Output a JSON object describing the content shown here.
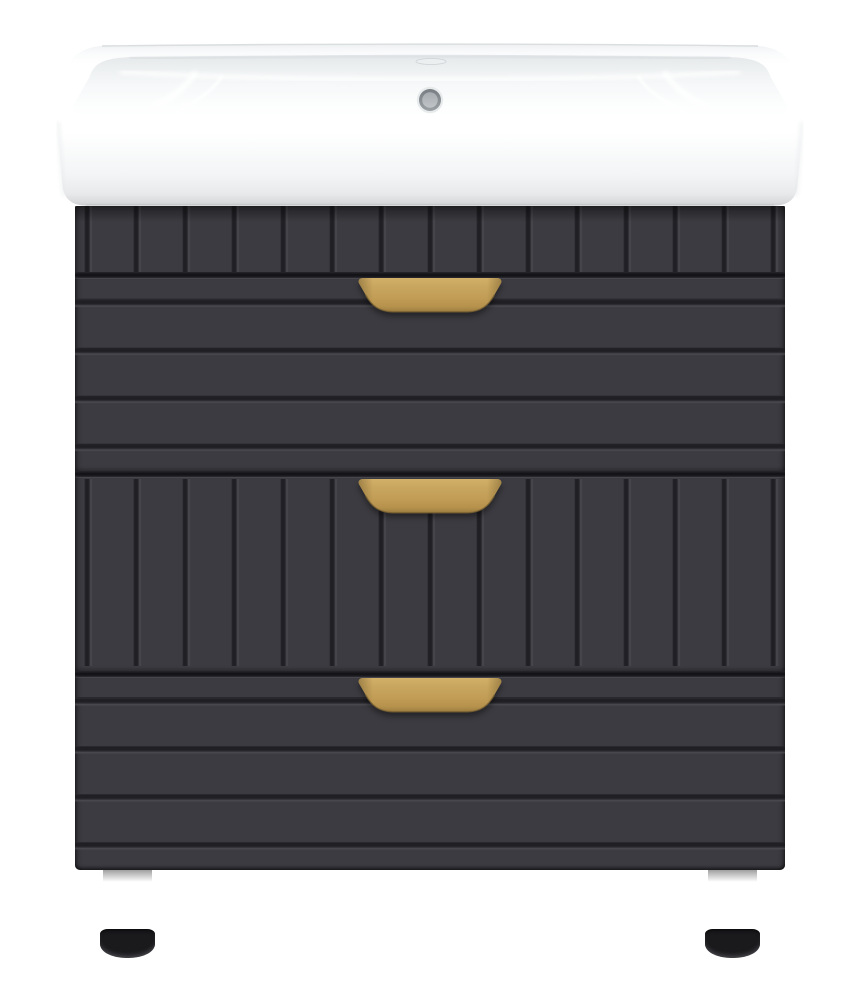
{
  "structure": {
    "drawer_count": 3,
    "handle_count": 3,
    "leg_count": 2,
    "top_panel_style": "vertical-slats",
    "drawer_1_style": "horizontal-grooves",
    "drawer_2_style": "vertical-slats",
    "drawer_3_style": "horizontal-grooves"
  },
  "labels": {
    "product": "floor-standing bathroom vanity with ceramic washbasin",
    "sink": "white ceramic washbasin",
    "faucet_hole": "faucet mounting hole",
    "overflow": "overflow hole",
    "cabinet": "charcoal cabinet with three drawers",
    "top_panel": "slatted apron panel",
    "drawer_top": "top drawer",
    "drawer_middle": "middle drawer",
    "drawer_bottom": "bottom drawer",
    "handle": "gold drawer handle",
    "leg_left": "left bronze leg",
    "leg_right": "right bronze leg"
  },
  "colors": {
    "page_bg": "#ffffff",
    "cabinet_body": "#3b3b41",
    "groove_core": "#1f1f24",
    "groove_soft": "#2e2e33",
    "groove_light": "#4b4b51",
    "gap_dark": "#121216",
    "gap_soft": "#26262b",
    "handle_gold_light": "#d3b068",
    "handle_gold": "#c09c55",
    "handle_gold_dark": "#9c7c40",
    "handle_edge": "#7d6433",
    "leg_bronze_light": "#cfbd99",
    "leg_bronze": "#a6946f",
    "leg_bronze_dark": "#4a3f31",
    "foot_black": "#1a1a1d",
    "sink_white": "#ffffff",
    "sink_bottom_edge": "#c9cbcd",
    "basin_shade": "#e4e7e9",
    "overflow_ring": "#777d82",
    "overflow_inner": "#a7acb0"
  }
}
